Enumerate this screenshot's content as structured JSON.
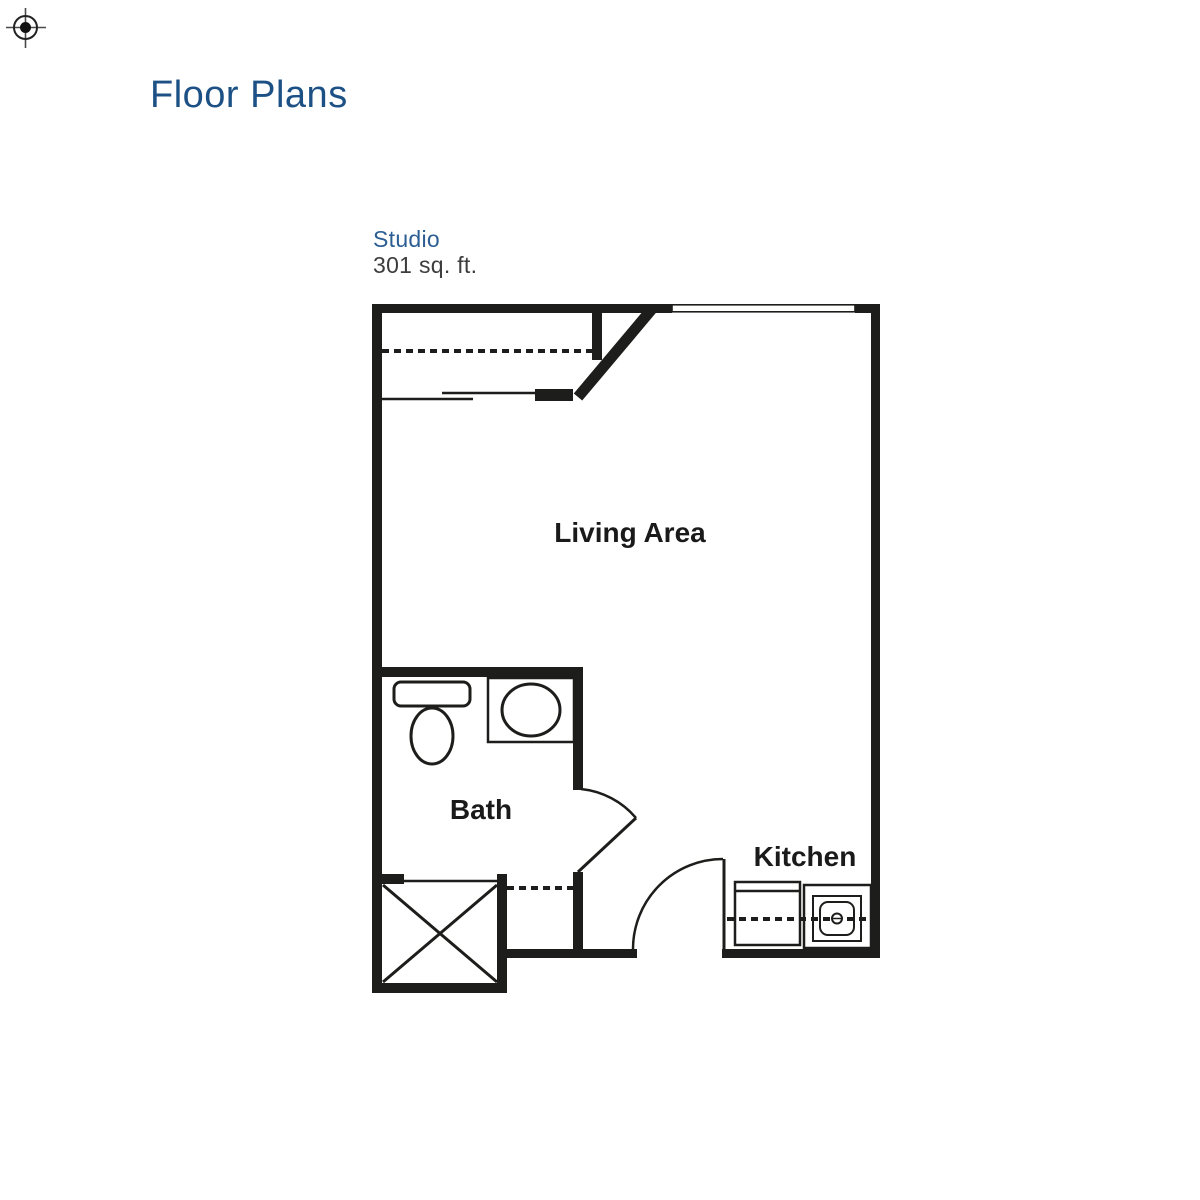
{
  "page": {
    "title": "Floor Plans"
  },
  "plan": {
    "name": "Studio",
    "area": "301 sq. ft.",
    "labels": {
      "living": "Living Area",
      "bath": "Bath",
      "kitchen": "Kitchen"
    }
  },
  "icons": {
    "registration_mark": "crosshair-registration-mark",
    "toilet": "toilet-icon",
    "bath_sink": "oval-sink-icon",
    "kitchen_sink": "kitchen-sink-icon",
    "refrigerator": "refrigerator-icon",
    "shower_closet": "x-box-shower-icon",
    "window": "window-symbol",
    "doors": "door-swing-arc"
  },
  "colors": {
    "heading_blue": "#1d5185",
    "subheading_blue": "#2c5e93",
    "body_text": "#3d3d3d",
    "plan_ink": "#1d1d1b",
    "background": "#ffffff"
  }
}
